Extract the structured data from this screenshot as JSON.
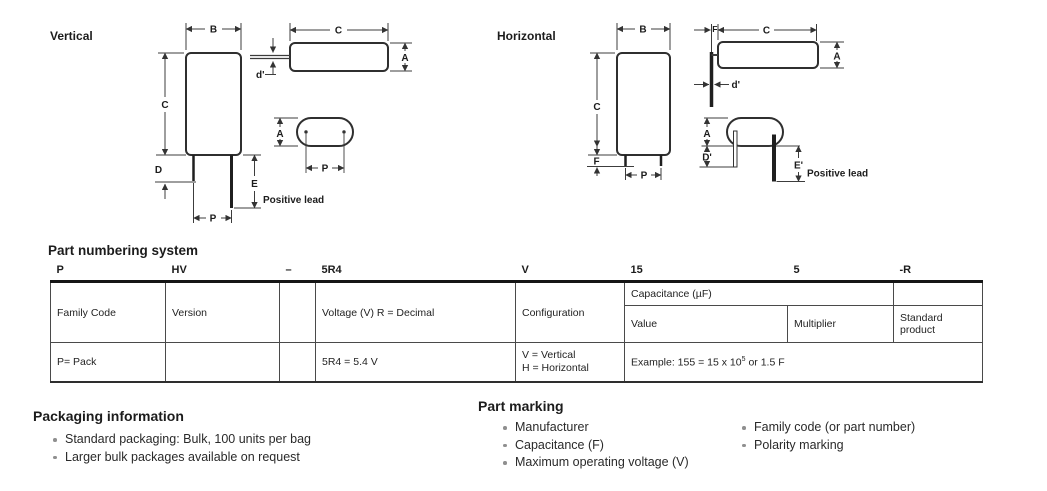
{
  "diagrams": {
    "vertical": {
      "label": "Vertical"
    },
    "horizontal": {
      "label": "Horizontal"
    },
    "dims": {
      "A": "A",
      "B": "B",
      "C": "C",
      "D": "D",
      "E": "E",
      "F": "F",
      "P": "P",
      "d2": "d'",
      "D2": "D'",
      "E2": "E'"
    },
    "positive_lead": "Positive lead"
  },
  "part_numbering": {
    "heading": "Part numbering system",
    "codes": {
      "family": "P",
      "version": "HV",
      "dash": "–",
      "voltage": "5R4",
      "config": "V",
      "value": "15",
      "multiplier": "5",
      "suffix": "-R"
    },
    "labels": {
      "family": "Family Code",
      "version": "Version",
      "voltage": "Voltage (V) R = Decimal",
      "config": "Configuration",
      "capacitance": "Capacitance (µF)",
      "value": "Value",
      "multiplier": "Multiplier",
      "standard": "Standard product"
    },
    "values": {
      "family": "P= Pack",
      "voltage": "5R4 = 5.4 V",
      "config_v": "V = Vertical",
      "config_h": "H = Horizontal",
      "example_prefix": "Example: 155 = 15 x 10",
      "example_exp": "5",
      "example_suffix": " or 1.5 F"
    }
  },
  "packaging": {
    "heading": "Packaging information",
    "items": [
      "Standard packaging: Bulk, 100 units per bag",
      "Larger bulk packages available on request"
    ]
  },
  "part_marking": {
    "heading": "Part marking",
    "items_left": [
      "Manufacturer",
      "Capacitance (F)",
      "Maximum operating voltage (V)"
    ],
    "items_right": [
      "Family code (or part number)",
      "Polarity marking"
    ]
  }
}
